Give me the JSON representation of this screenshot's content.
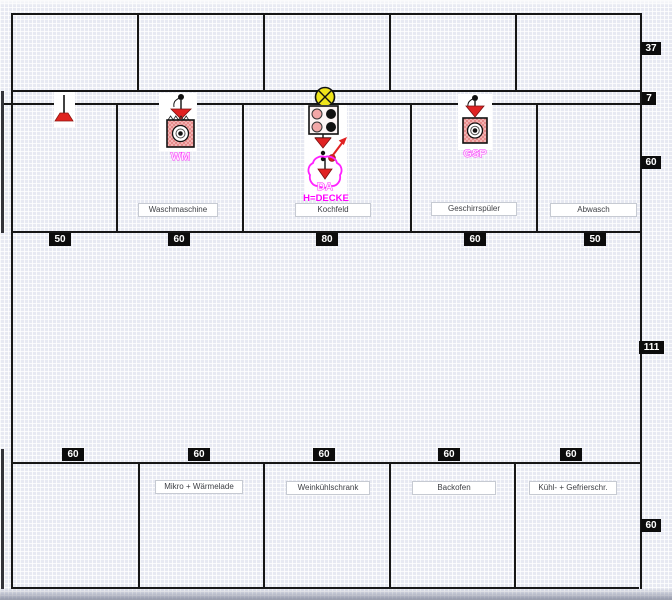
{
  "labels": {
    "mid": [
      "Waschmaschine",
      "Kochfeld",
      "Geschirrspüler",
      "Abwasch"
    ],
    "bottom": [
      "Mikro + Wärmelade",
      "Weinkühlschrank",
      "Backofen",
      "Kühl- + Gefrierschr."
    ]
  },
  "dims": {
    "mid": [
      "50",
      "60",
      "80",
      "60",
      "50"
    ],
    "bottom": [
      "60",
      "60",
      "60",
      "60",
      "60"
    ],
    "right": [
      "37",
      "7",
      "60",
      "111",
      "60"
    ]
  },
  "symbols": {
    "washing_machine": "WM",
    "dishwasher": "GSP",
    "hood": "DA",
    "hood_height": "H=DECKE"
  },
  "colors": {
    "line": "#161616",
    "magenta": "#ff00ff",
    "red": "#df2420",
    "pink": "#f3b9b9",
    "yellow": "#efe41a",
    "dim_bg": "#0c0c0c",
    "grid_base": "#e7e9f2"
  }
}
